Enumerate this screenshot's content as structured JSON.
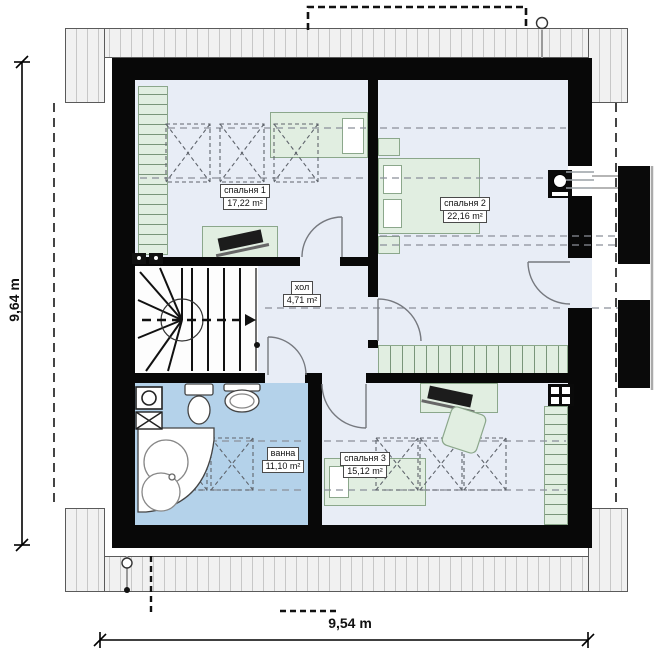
{
  "rooms": [
    {
      "id": "bedroom1",
      "name": "спальня 1",
      "area": "17,22 m²"
    },
    {
      "id": "bedroom2",
      "name": "спальня 2",
      "area": "22,16 m²"
    },
    {
      "id": "hall",
      "name": "хол",
      "area": "4,71 m²"
    },
    {
      "id": "bath",
      "name": "ванна",
      "area": "11,10 m²"
    },
    {
      "id": "bedroom3",
      "name": "спальня 3",
      "area": "15,12 m²"
    }
  ],
  "dimensions": {
    "width": "9,54 m",
    "height": "9,64 m"
  },
  "colors": {
    "wall": "#080808",
    "floor": "#e8edf6",
    "bathroom_floor": "#b4d2ea",
    "furniture": "#e1eee1",
    "roof_band_stripe": "#c7c7c7"
  },
  "fixtures": [
    "staircase",
    "bathtub",
    "toilet",
    "sink",
    "washing-machine",
    "bed",
    "desk",
    "wardrobe",
    "skylight",
    "balcony",
    "chimney"
  ]
}
